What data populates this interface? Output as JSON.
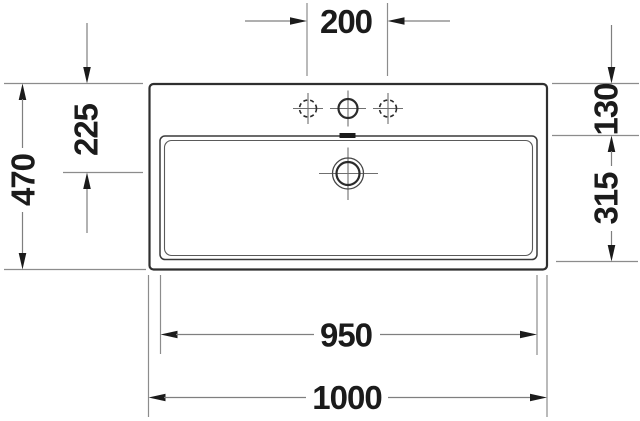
{
  "drawing": {
    "type": "technical-dimension-drawing",
    "subject": "washbasin-top-view",
    "features": [
      "outer-rim",
      "inner-basin",
      "overflow-slot",
      "drain",
      "faucet-hole-center",
      "faucet-hole-left-optional",
      "faucet-hole-right-optional"
    ]
  },
  "dimensions": {
    "faucet_hole_spacing": "200",
    "front_edge_to_drain": "225",
    "overall_depth": "470",
    "rim_to_basin_edge": "130",
    "basin_depth": "315",
    "basin_inner_width": "950",
    "overall_width": "1000"
  },
  "colors": {
    "background": "#ffffff",
    "drawing_line": "#2f2f2f",
    "dimension_line": "#8c8c8c",
    "text": "#1b1b1b"
  }
}
